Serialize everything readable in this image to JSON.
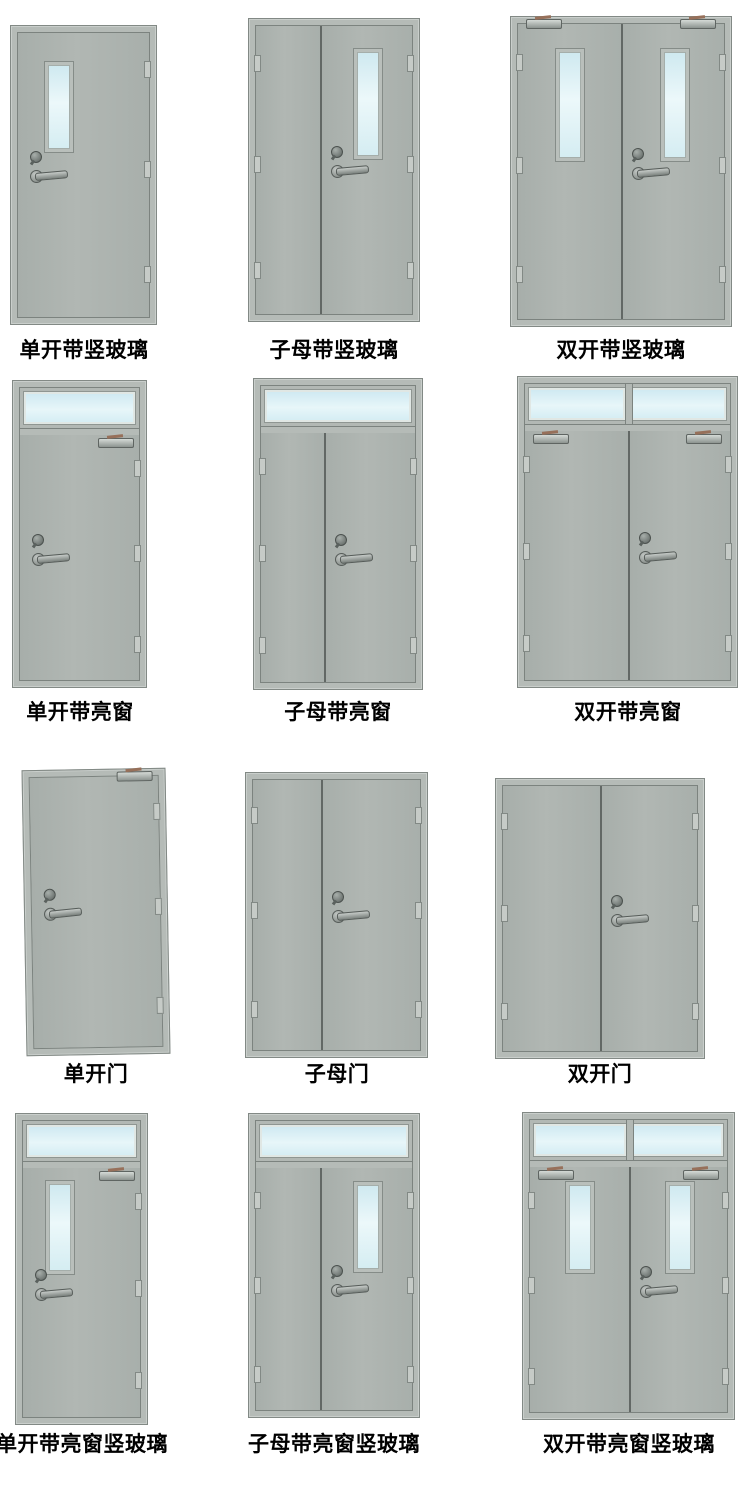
{
  "palette": {
    "background": "#ffffff",
    "door_face": "#abb2ae",
    "door_frame": "#b5bbb7",
    "frame_edge": "#828985",
    "divider": "#626865",
    "glass_blue": "#cfe9f0",
    "glass_highlight": "#ecf8fa",
    "hardware_dark": "#5a615e",
    "hardware_light": "#c6cbc8",
    "closer_arm_accent": "#97705a",
    "label_color": "#000000"
  },
  "doors": [
    {
      "label": "单开带竖玻璃",
      "type": "single",
      "transom": "none",
      "vision_glass": "single-leaf",
      "closers": "none"
    },
    {
      "label": "子母带竖玻璃",
      "type": "mother-son",
      "transom": "none",
      "vision_glass": "main-leaf",
      "closers": "none"
    },
    {
      "label": "双开带竖玻璃",
      "type": "double",
      "transom": "none",
      "vision_glass": "both-leaves",
      "closers": "both"
    },
    {
      "label": "单开带亮窗",
      "type": "single",
      "transom": "full",
      "vision_glass": "none",
      "closers": "right"
    },
    {
      "label": "子母带亮窗",
      "type": "mother-son",
      "transom": "full",
      "vision_glass": "none",
      "closers": "none"
    },
    {
      "label": "双开带亮窗",
      "type": "double",
      "transom": "split",
      "vision_glass": "none",
      "closers": "both"
    },
    {
      "label": "单开门",
      "type": "single",
      "transom": "none",
      "vision_glass": "none",
      "closers": "right"
    },
    {
      "label": "子母门",
      "type": "mother-son",
      "transom": "none",
      "vision_glass": "none",
      "closers": "none"
    },
    {
      "label": "双开门",
      "type": "double",
      "transom": "none",
      "vision_glass": "none",
      "closers": "none"
    },
    {
      "label": "单开带亮窗竖玻璃",
      "type": "single",
      "transom": "full",
      "vision_glass": "single-leaf",
      "closers": "right"
    },
    {
      "label": "子母带亮窗竖玻璃",
      "type": "mother-son",
      "transom": "full",
      "vision_glass": "main-leaf",
      "closers": "none"
    },
    {
      "label": "双开带亮窗竖玻璃",
      "type": "double",
      "transom": "split",
      "vision_glass": "both-leaves",
      "closers": "both"
    }
  ]
}
